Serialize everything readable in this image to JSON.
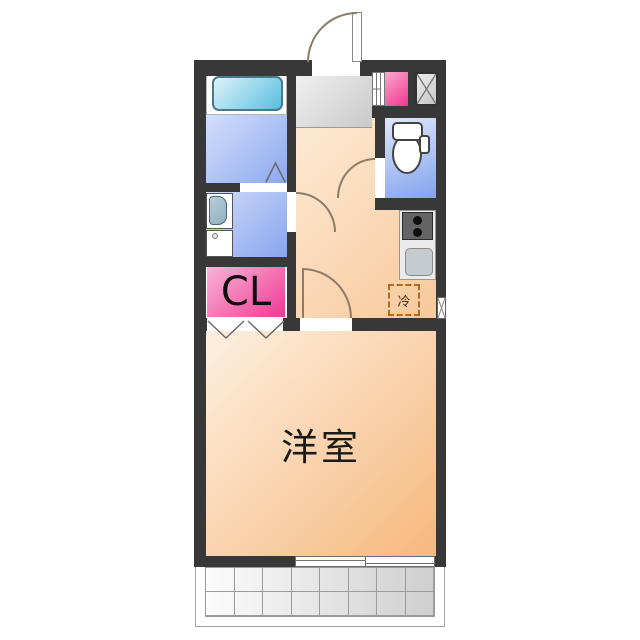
{
  "floorplan": {
    "rooms": {
      "western_room_label": "洋室",
      "closet_label": "CL",
      "refrigerator_label": "冷"
    },
    "colors": {
      "wall": "#383838",
      "room_floor": "#f6b87e",
      "hall_floor": "#f8c99b",
      "water_area_blue": "#8da8ef",
      "bathtub_cyan": "#58bfe0",
      "closet_pink": "#ee3a94",
      "entrance_grey": "#c9c9c9",
      "fridge_dashed_border": "#ad6b26"
    },
    "balcony": {
      "rows": 2,
      "cols": 8
    },
    "fixtures": [
      "entrance-door",
      "bathtub",
      "folding-bath-door-mark",
      "washbasin",
      "washing-machine-pan",
      "toilet",
      "gas-stove",
      "kitchen-sink",
      "refrigerator-space",
      "shoe-cabinet",
      "pipe-space",
      "meter-box",
      "closet-folding-doors",
      "sliding-window",
      "balcony-tiles"
    ]
  }
}
